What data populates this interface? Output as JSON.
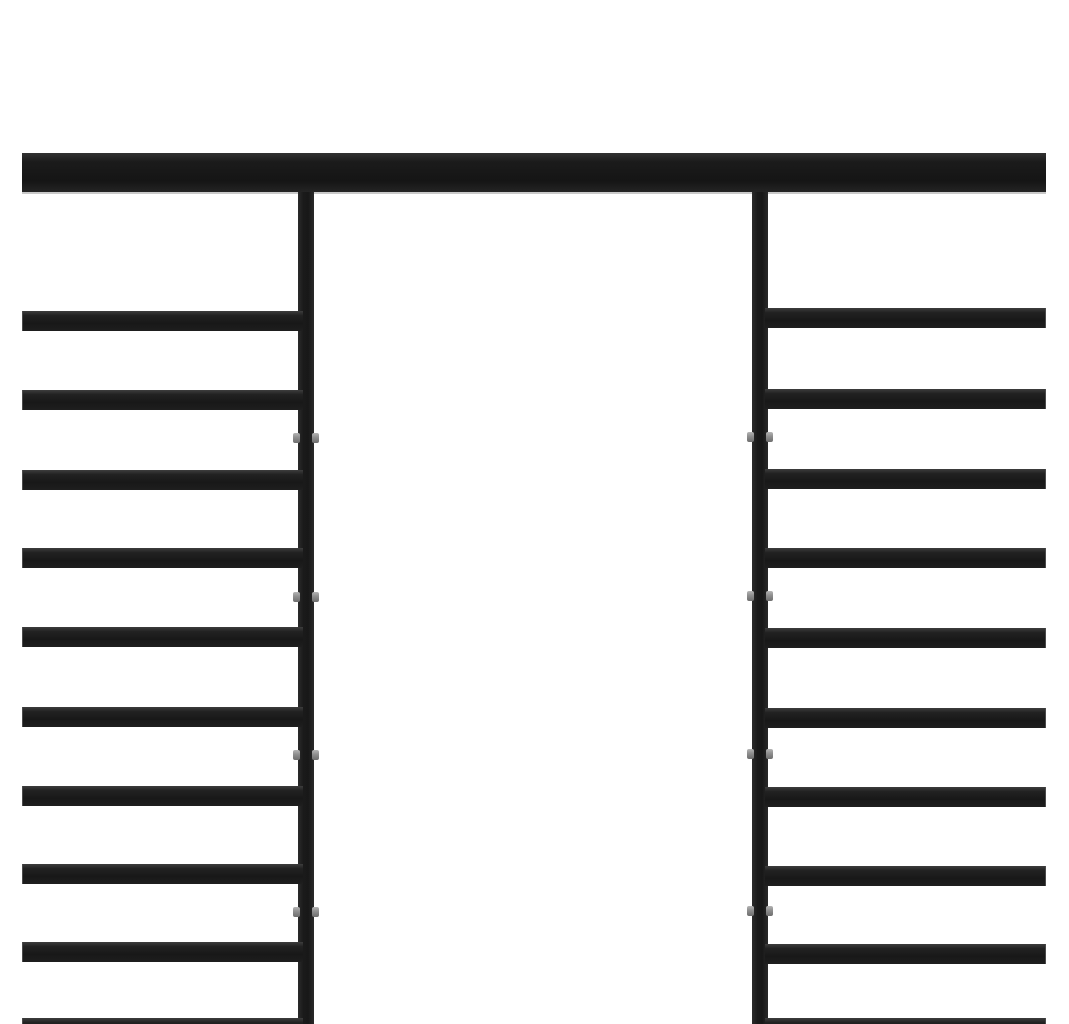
{
  "image": {
    "kind": "product-photo",
    "description": "Close-up section of a black powder-coated steel pergola frame: one solid horizontal top beam, two vertical square posts with small metal bolt connectors, and ten evenly spaced horizontal roof slats extending left and right of the posts, photographed on a plain white background.",
    "background_color": "#ffffff"
  },
  "palette": {
    "frame_black": "#1c1c1c",
    "frame_highlight": "#3d3d3d",
    "beam_shadow_line": "#c9c9c9",
    "bolt_gray": "#949494",
    "background": "#ffffff"
  },
  "geometry": {
    "canvas": {
      "width": 1069,
      "height": 1024
    },
    "beam": {
      "x": 22,
      "y": 153,
      "width": 1024,
      "height": 39
    },
    "posts": [
      {
        "side": "left",
        "x": 298,
        "y": 192,
        "width": 16,
        "height": 832
      },
      {
        "side": "right",
        "x": 752,
        "y": 192,
        "width": 16,
        "height": 832
      }
    ],
    "slats": {
      "height": 20,
      "left": {
        "x": 22,
        "width": 281,
        "tops": [
          311,
          390,
          470,
          548,
          627,
          707,
          786,
          864,
          942,
          1018
        ]
      },
      "right": {
        "x": 765,
        "width": 281,
        "tops": [
          308,
          389,
          469,
          548,
          628,
          708,
          787,
          866,
          944,
          1018
        ]
      }
    },
    "bolts": {
      "width": 7,
      "height": 10,
      "side_protrusion": 5,
      "left_post_ys": [
        438,
        597,
        755,
        912
      ],
      "right_post_ys": [
        437,
        596,
        754,
        911
      ]
    }
  }
}
